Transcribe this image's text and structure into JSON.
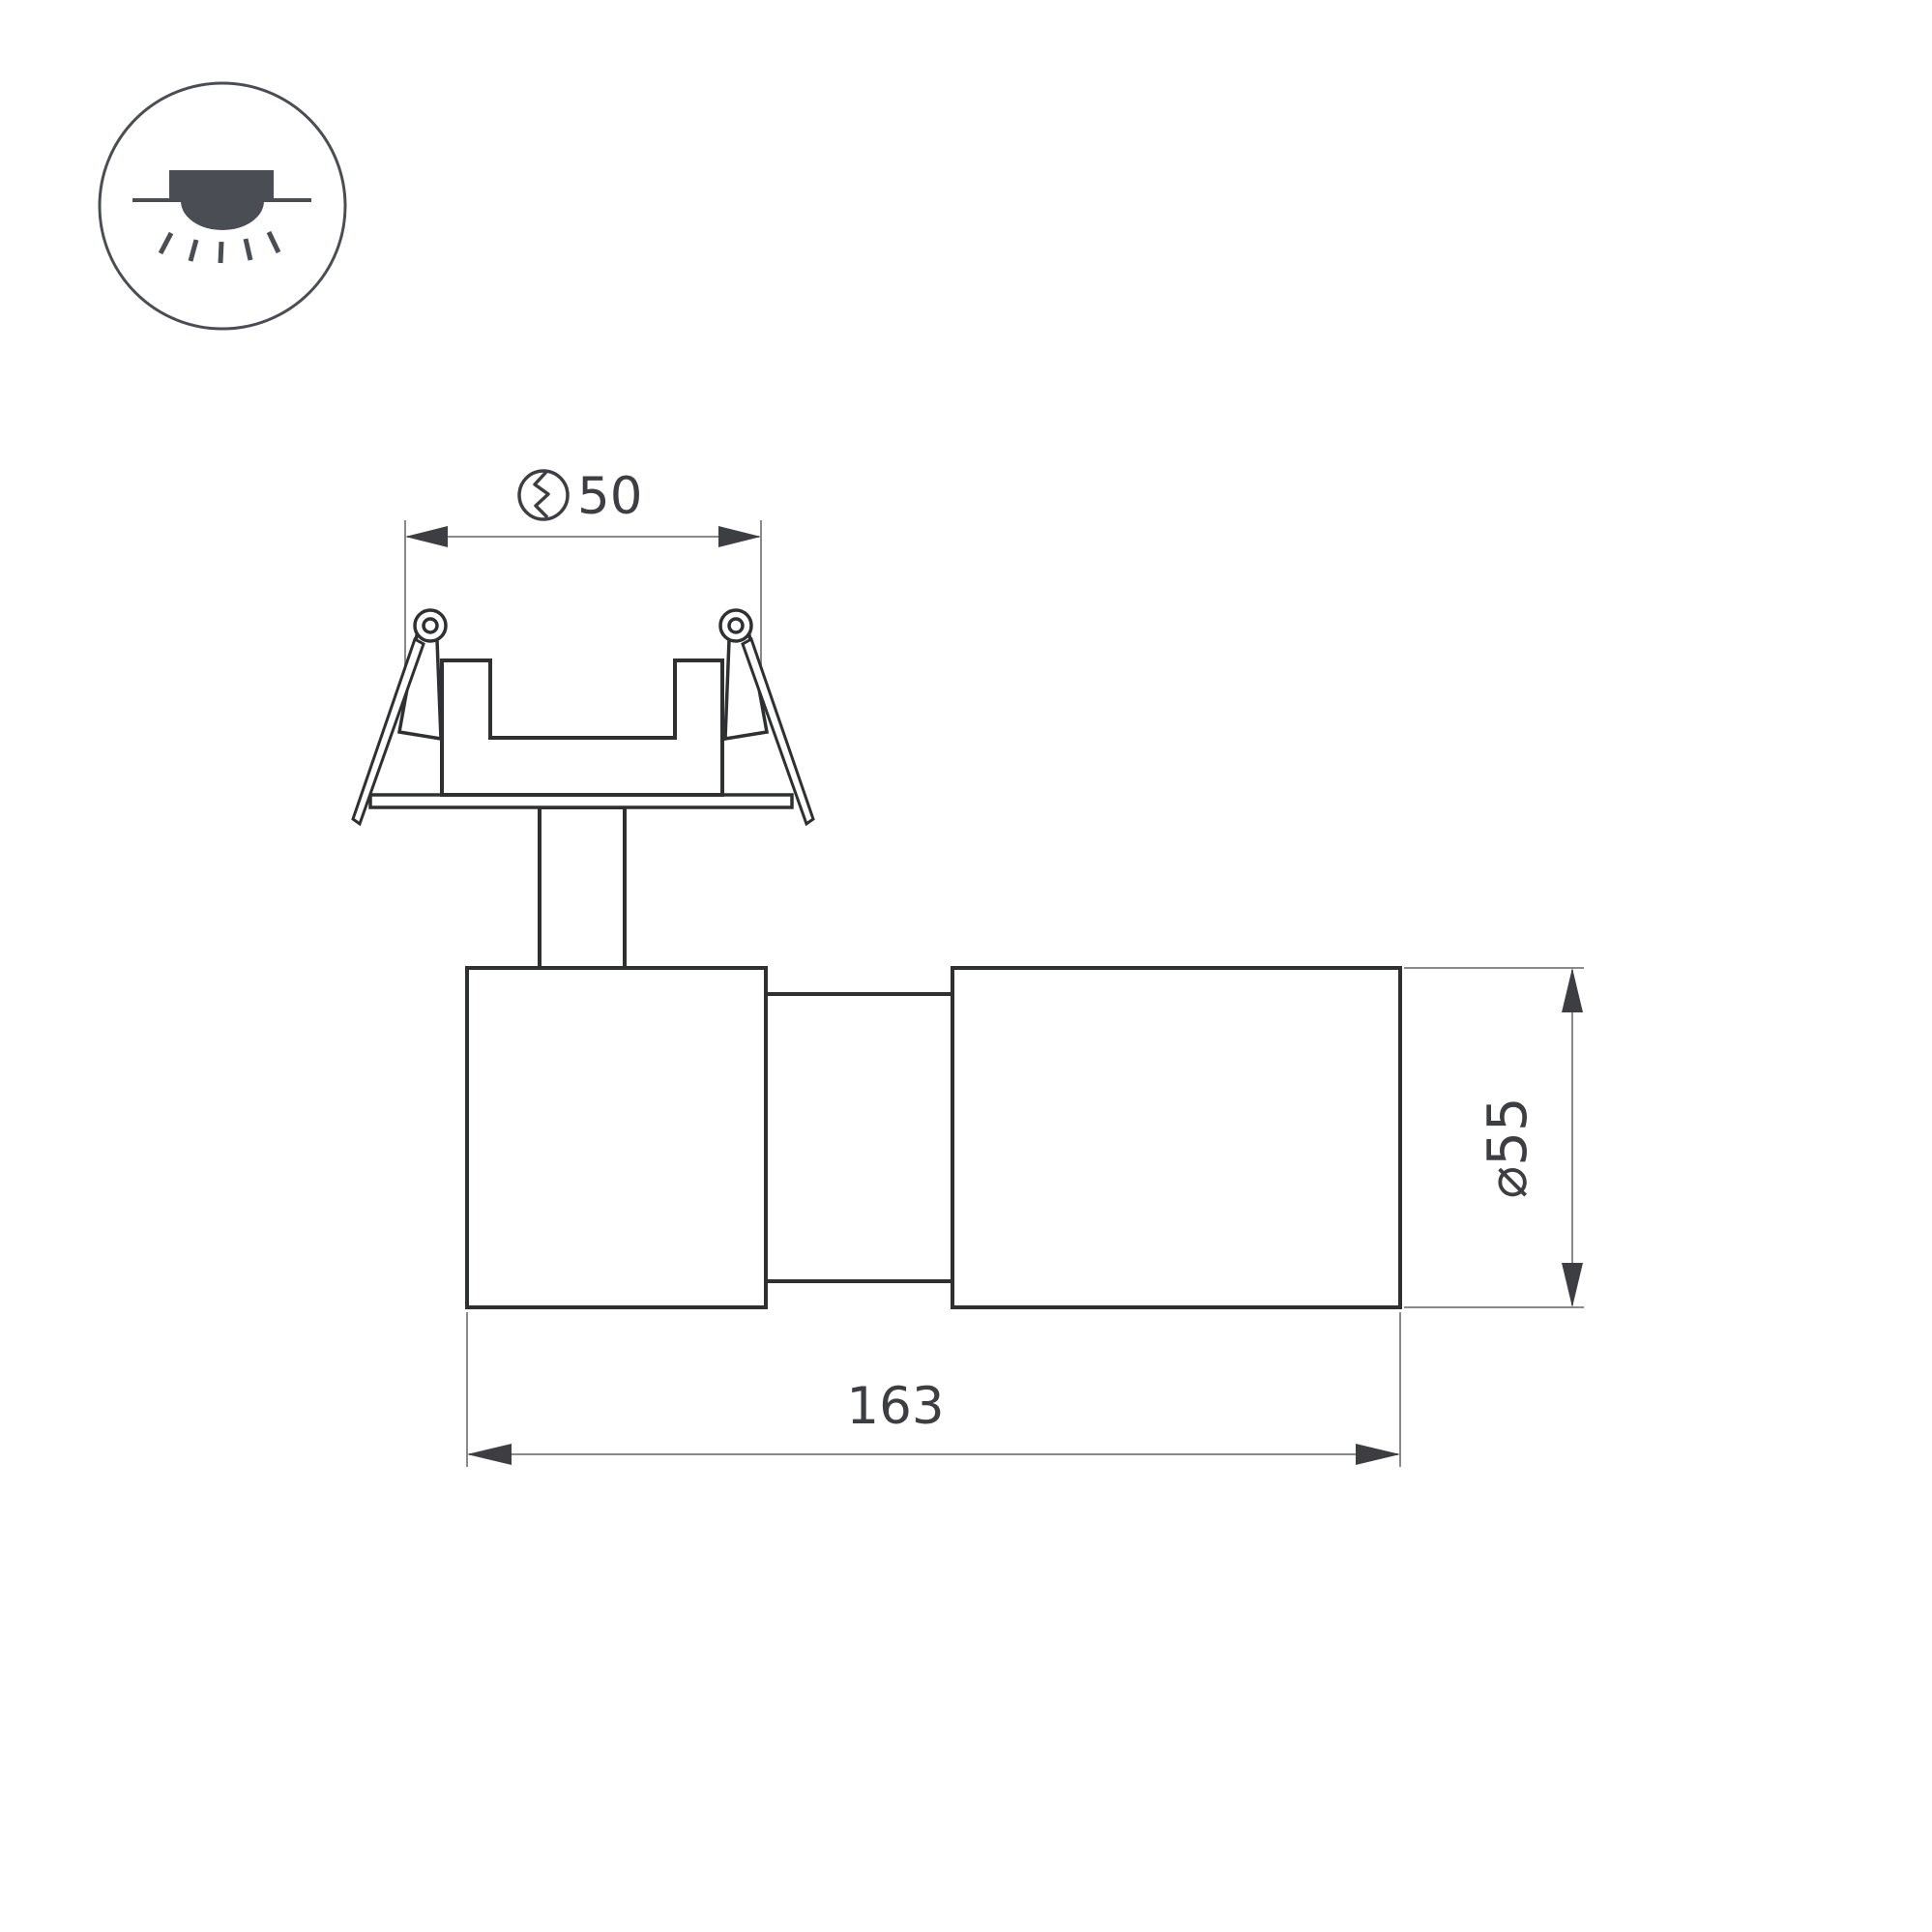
{
  "drawing": {
    "type": "technical-dimension-drawing",
    "subject": "recessed-spot-luminaire-side-view",
    "legend_icon": "recessed-downlight-icon",
    "dimensions": {
      "cutout": {
        "symbol": "hole-cutout-icon",
        "value": "50"
      },
      "diameter": {
        "value": "⌀55"
      },
      "length": {
        "value": "163"
      }
    },
    "colors": {
      "outline": "#2f3032",
      "dimension_line": "#8a8a8c",
      "dimension_text": "#3d3e42",
      "icon": "#4a4d53",
      "background": "#ffffff"
    }
  }
}
